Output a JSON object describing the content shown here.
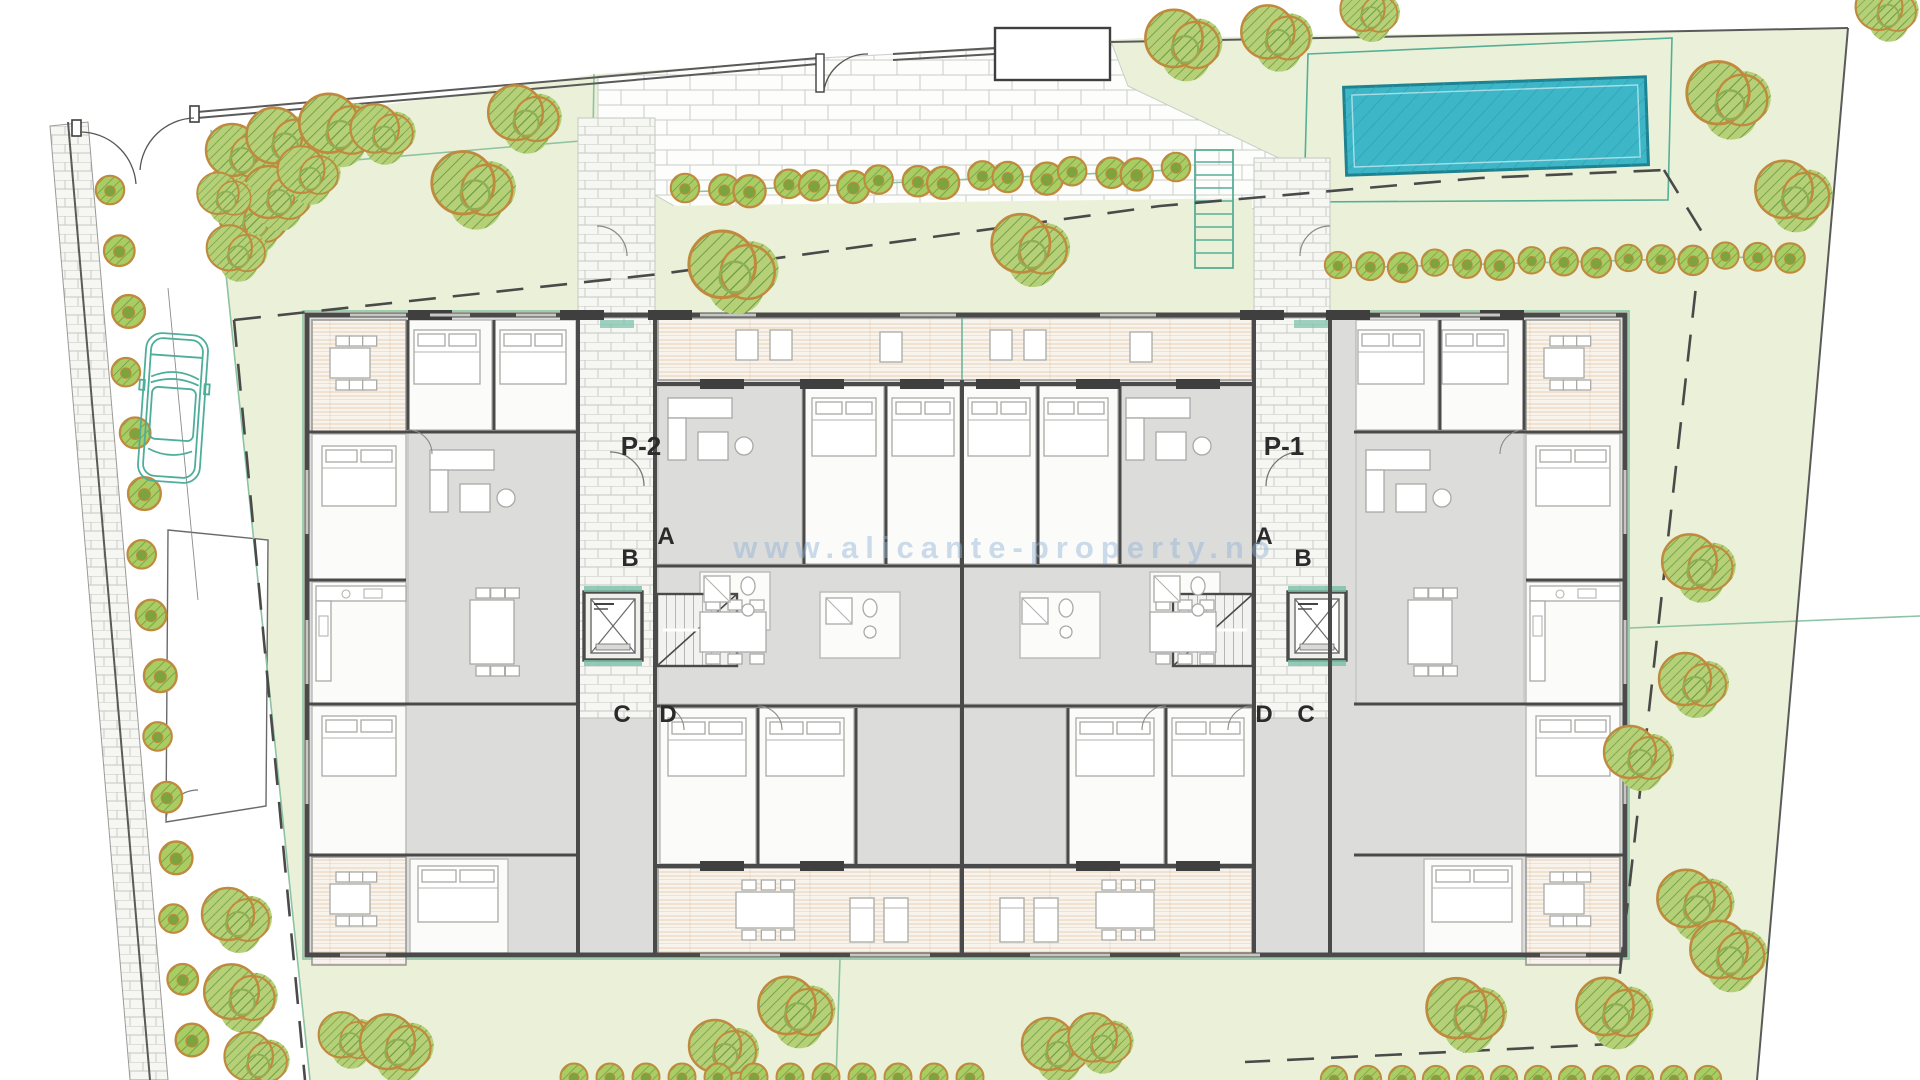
{
  "plan": {
    "watermark": "www.alicante-property.no",
    "portals": {
      "left": "P-2",
      "right": "P-1"
    },
    "letters": {
      "a": "A",
      "b": "B",
      "c": "C",
      "d": "D"
    },
    "colors": {
      "paper": "#ffffff",
      "lawn": "#eaf1d8",
      "lawn_line": "#8cc3a3",
      "brick_joint": "#c9cdc8",
      "pool": "#3db7c8",
      "pool_rim": "#1f8290",
      "deck_stripe": "#d8a36b",
      "wall": "#4a4a4a",
      "room_gray": "#dcdcdb",
      "room_white": "#fbfbfa",
      "tree_fill": "#b5d077",
      "tree_outline": "#c08a3e",
      "tree_hatch": "#6f9e46",
      "accent": "#57ae96",
      "boundary": "#5a5a5a",
      "label": "#2b2b2b",
      "watermark_color": "#8fb3d6"
    }
  }
}
